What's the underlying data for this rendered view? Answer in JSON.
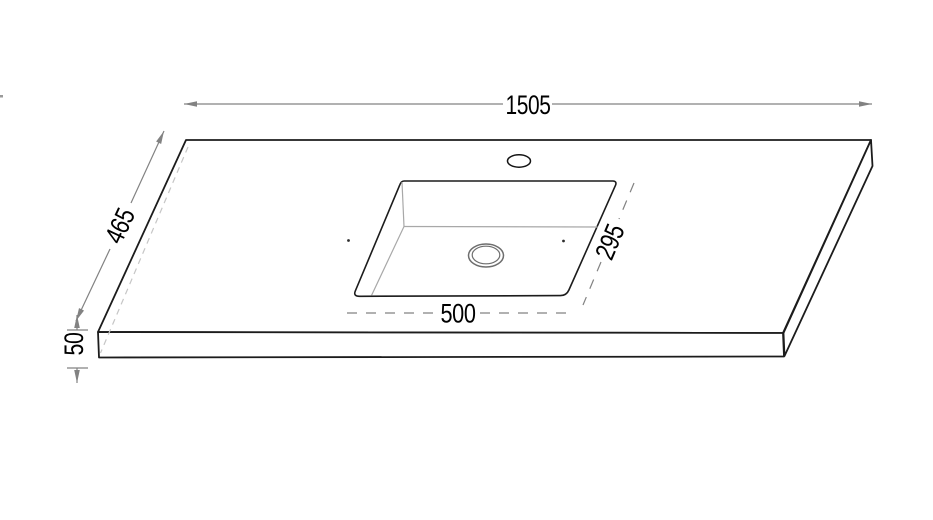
{
  "drawing": {
    "dimensions": {
      "overall_width": "1505",
      "overall_depth": "465",
      "thickness": "50",
      "basin_width": "500",
      "basin_depth": "295"
    },
    "colors": {
      "outline": "#1c1c1c",
      "dimension_line": "#828282",
      "interior_edge": "#a8a8a8",
      "hidden_edge": "#c6c6c6",
      "drain_outline": "#6e6e6e",
      "text": "#000000",
      "background": "#ffffff"
    }
  }
}
